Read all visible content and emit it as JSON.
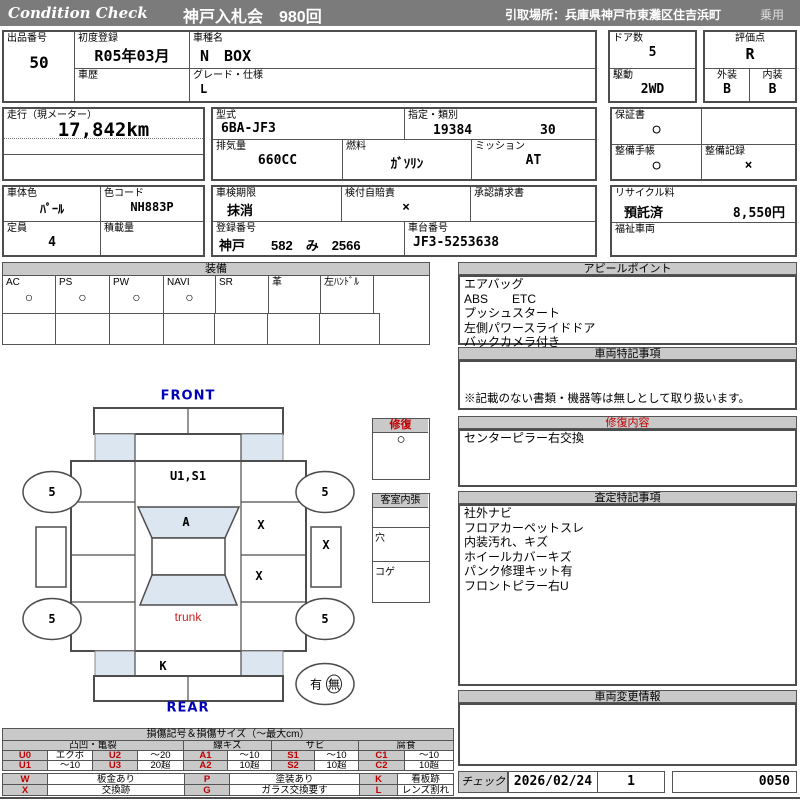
{
  "colors": {
    "topbar": "#7b7b7b",
    "section_bar": "#c9c9c9",
    "accent_red": "#c00000",
    "accent_blue": "#0000bb",
    "panel_blue": "#dce6f1"
  },
  "topbar": {
    "brand": "Condition  Check",
    "auction": "神戸入札会　980回",
    "pickup": "引取場所：兵庫県神戸市東灘区住吉浜町",
    "class": "乗用"
  },
  "info": {
    "lot_label": "出品番号",
    "lot": "50",
    "first_reg_label": "初度登録",
    "first_reg": "R05年03月",
    "history_label": "車歴",
    "history": "",
    "model_label": "車種名",
    "model": "N　BOX",
    "grade_label": "グレード・仕様",
    "grade": "L",
    "doors_label": "ドア数",
    "doors": "5",
    "drive_label": "駆動",
    "drive": "2WD",
    "score_label": "評価点",
    "score": "R",
    "ext_label": "外装",
    "ext": "B",
    "int_label": "内装",
    "int": "B",
    "mileage_label": "走行（現メーター）",
    "mileage": "17,842km",
    "model_code_label": "型式",
    "model_code": "6BA-JF3",
    "class_label": "指定・類別",
    "class1": "19384",
    "class2": "30",
    "disp_label": "排気量",
    "disp": "660CC",
    "fuel_label": "燃料",
    "fuel": "ｶﾞｿﾘﾝ",
    "mission_label": "ミッション",
    "mission": "AT",
    "warranty_label": "保証書",
    "warranty": "○",
    "book_label": "整備手帳",
    "book": "○",
    "record_label": "整備記録",
    "record": "×",
    "color_label": "車体色",
    "color": "ﾊﾟｰﾙ",
    "colorcode_label": "色コード",
    "colorcode": "NH883P",
    "shaken_label": "車検期限",
    "shaken": "抹消",
    "jibai_label": "検付自賠責",
    "jibai": "×",
    "approval_label": "承認請求書",
    "approval": "",
    "recycle_label": "リサイクル料",
    "recycle_status": "預託済",
    "recycle_fee": "8,550円",
    "capacity_label": "定員",
    "capacity": "4",
    "load_label": "積載量",
    "load": "",
    "plate_label": "登録番号",
    "plate": "神戸　　582　み　2566",
    "vin_label": "車台番号",
    "vin": "JF3-5253638",
    "welfare_label": "福祉車両",
    "welfare": ""
  },
  "equipment": {
    "title": "装備",
    "items": [
      {
        "label": "AC",
        "mark": "○"
      },
      {
        "label": "PS",
        "mark": "○"
      },
      {
        "label": "PW",
        "mark": "○"
      },
      {
        "label": "NAVI",
        "mark": "○"
      },
      {
        "label": "SR",
        "mark": ""
      },
      {
        "label": "革",
        "mark": ""
      },
      {
        "label": "左ﾊﾝﾄﾞﾙ",
        "mark": ""
      },
      {
        "label": "",
        "mark": ""
      }
    ]
  },
  "diagram": {
    "front_label": "FRONT",
    "rear_label": "REAR",
    "hood_mark": "U1,S1",
    "windshield_mark": "A",
    "trunk_label": "trunk",
    "rear_mark": "K",
    "x_upper": "X",
    "x_side": "X",
    "x_lower": "X",
    "wheel": "5",
    "spare_has": "有",
    "spare_none": "無"
  },
  "repair_box": {
    "title": "修復",
    "mark": "○"
  },
  "interior_box": {
    "title": "客室内張",
    "rows": [
      "ヤブレ",
      "穴",
      "コゲ"
    ]
  },
  "appeal": {
    "title": "アピールポイント",
    "lines": [
      "エアバッグ",
      "ABS　　ETC",
      "プッシュスタート",
      "左側パワースライドドア",
      "バックカメラ付き"
    ]
  },
  "vehicle_notes": {
    "title": "車両特記事項",
    "note": "※記載のない書類・機器等は無しとして取り扱います。"
  },
  "repair": {
    "title": "修復内容",
    "lines": [
      "センターピラー右交換"
    ]
  },
  "assessment": {
    "title": "査定特記事項",
    "lines": [
      "社外ナビ",
      "フロアカーペットスレ",
      "内装汚れ、キズ",
      "ホイールカバーキズ",
      "パンク修理キット有",
      "フロントピラー右U"
    ]
  },
  "change_info": {
    "title": "車両変更情報"
  },
  "check": {
    "label": "チェック",
    "date": "2026/02/24",
    "count": "1",
    "number": "0050"
  },
  "legend": {
    "title": "損傷記号＆損傷サイズ（〜最大cm）",
    "groups": [
      "凸凹・亀裂",
      "線キズ",
      "サビ",
      "腐食"
    ],
    "row1": [
      "U0",
      "エクボ",
      "U2",
      "〜20",
      "A1",
      "〜10",
      "S1",
      "〜10",
      "C1",
      "〜10"
    ],
    "row2": [
      "U1",
      "〜10",
      "U3",
      "20超",
      "A2",
      "10超",
      "S2",
      "10超",
      "C2",
      "10超"
    ],
    "row3": [
      "W",
      "板金あり",
      "P",
      "塗装あり",
      "K",
      "看板跡"
    ],
    "row4": [
      "X",
      "交換跡",
      "G",
      "ガラス交換要す",
      "L",
      "レンズ割れ"
    ]
  }
}
